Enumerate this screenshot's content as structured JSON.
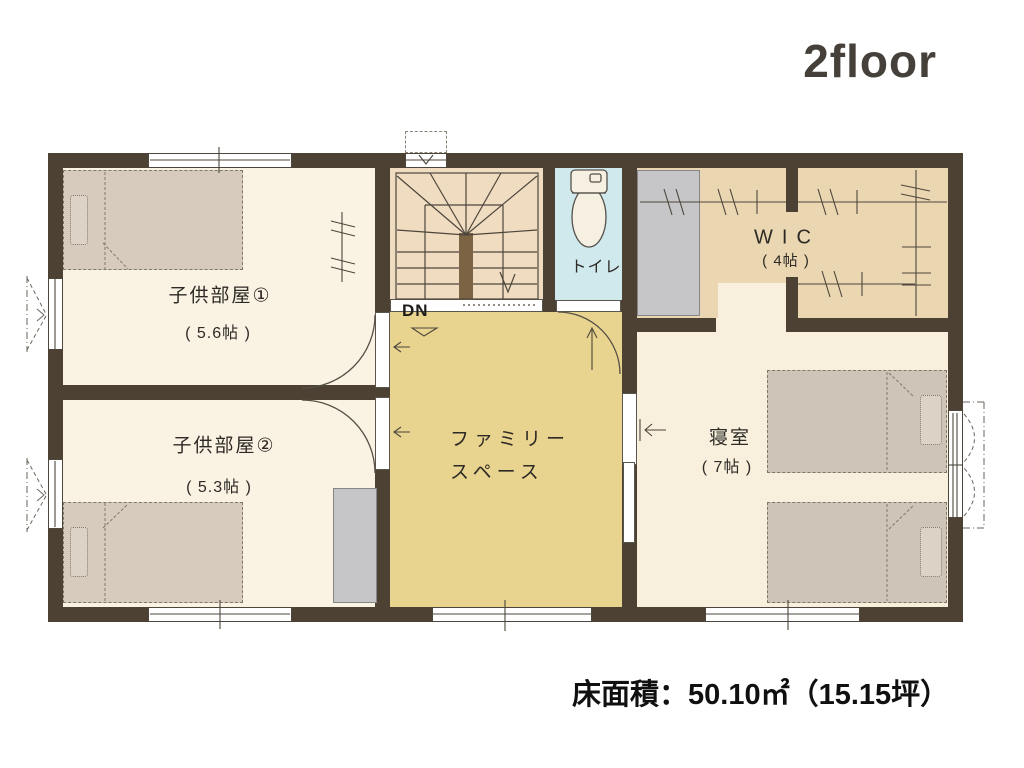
{
  "title": "2floor",
  "area_summary": "床面積：50.10㎡（15.15坪）",
  "rooms": {
    "child_room_1": {
      "name": "子供部屋①",
      "size": "( 5.6帖 )"
    },
    "child_room_2": {
      "name": "子供部屋②",
      "size": "( 5.3帖 )"
    },
    "family_space": {
      "name_line_1": "ファミリー",
      "name_line_2": "スペース"
    },
    "bedroom": {
      "name": "寝室",
      "size": "( 7帖 )"
    },
    "wic": {
      "name": "WIC",
      "size": "( 4帖 )"
    },
    "toilet": {
      "name": "トイレ"
    },
    "stairs": {
      "down_label": "DN"
    }
  },
  "colors": {
    "wall": "#4c4133",
    "child_room_floor": "#faf2e3",
    "family_floor": "#e8d48e",
    "stairs_floor": "#f0dcc0",
    "wic_floor": "#ead7b2",
    "toilet_floor": "#cfe9ed",
    "bedroom_floor": "#f8f0dc",
    "bed": "#d6cbbd",
    "closet": "#c6c6c8",
    "title_text": "#45413a"
  }
}
